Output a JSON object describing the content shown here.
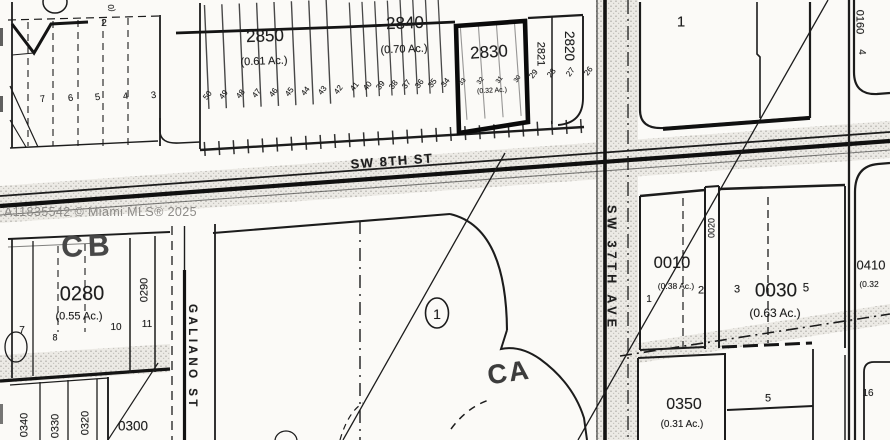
{
  "watermark": "A11835542 © Miami MLS® 2025",
  "streets": {
    "sw_8th_st": "SW 8TH ST",
    "sw_37th_ave": "SW 37TH AVE",
    "galiano_st": "GALIANO ST"
  },
  "blocks": {
    "b2850": {
      "id": "2850",
      "area": "(0.61 Ac.)",
      "lots": [
        "50",
        "49",
        "48",
        "47",
        "46",
        "45",
        "44",
        "43",
        "42"
      ]
    },
    "b2840": {
      "id": "2840",
      "area": "(0.70 Ac.)",
      "lots": [
        "41",
        "40",
        "39",
        "38",
        "37",
        "36",
        "35",
        "34"
      ]
    },
    "subject": {
      "id": "2830",
      "area": "(0.32 Ac.)",
      "lots": [
        "33",
        "32",
        "31",
        "30"
      ]
    },
    "b2821": {
      "id": "2821"
    },
    "b2820": {
      "id": "2820",
      "lots": [
        "29",
        "28",
        "27",
        "26"
      ]
    },
    "block1": {
      "lot": "1"
    },
    "b0160": {
      "id": "0160",
      "lot": "4"
    },
    "top_left": {
      "lots": [
        "7",
        "6",
        "5",
        "4",
        "3"
      ],
      "lot_2": "2",
      "partial_label": "(0"
    },
    "cb": {
      "zone": "CB",
      "id": "0280",
      "area": "(0.55 Ac.)",
      "lot_7": "7",
      "lot_8": "8",
      "lot_10": "10",
      "lot_11": "11",
      "strip_id": "0290"
    },
    "bottom_left": {
      "id_0340": "0340",
      "id_0330": "0330",
      "id_0320": "0320",
      "id_0300": "0300"
    },
    "center": {
      "lot": "1",
      "ca": "CA"
    },
    "b0010": {
      "id": "0010",
      "area": "(0.38 Ac.)",
      "lot_1": "1",
      "lot_2": "2",
      "strip_id": "0020",
      "lot_3": "3"
    },
    "b0030": {
      "id": "0030",
      "area": "(0.63 Ac.)",
      "lot_5": "5"
    },
    "b0410": {
      "id": "0410",
      "area": "(0.32"
    },
    "b0350": {
      "id": "0350",
      "area": "(0.31 Ac.)",
      "lot_5": "5",
      "lot_16": "16"
    }
  }
}
